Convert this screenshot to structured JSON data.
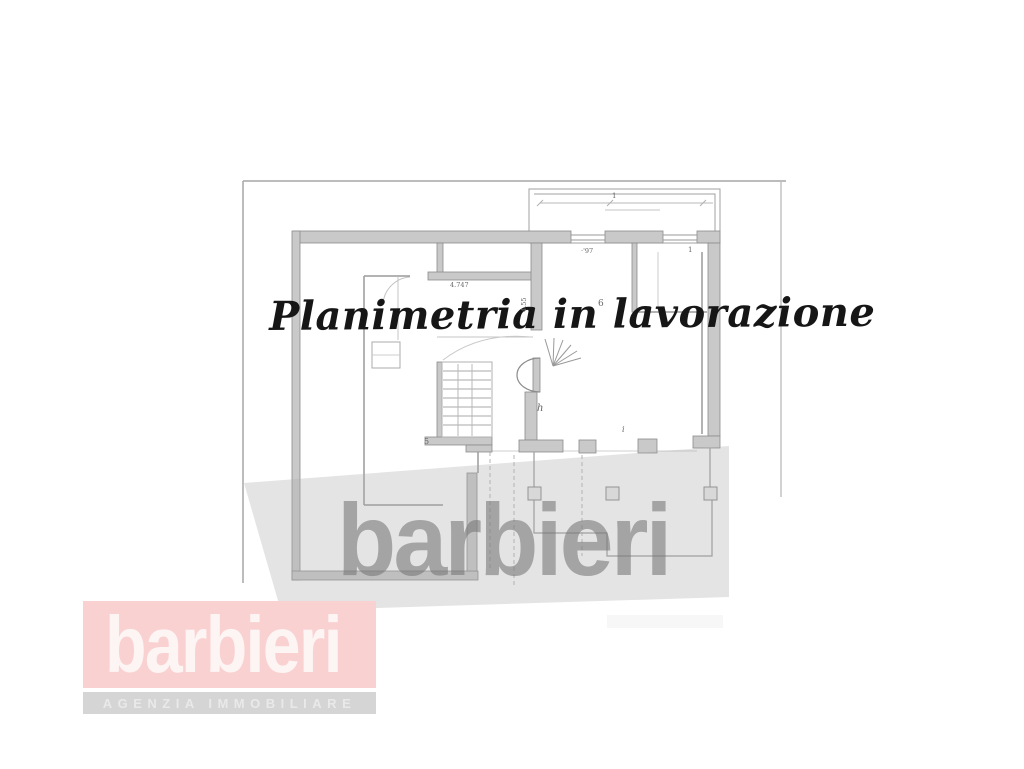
{
  "watermarks": {
    "script_text": "Planimetria in lavorazione",
    "brand_text": "barbieri",
    "brand_color": "#b5b5b5",
    "band_color": "rgba(172,172,172,0.32)"
  },
  "logo": {
    "brand": "barbieri",
    "subtitle": "AGENZIA IMMOBILIARE",
    "brand_bg_color": "#fad1d1",
    "brand_text_color": "#fdf4f4",
    "subtitle_bg_color": "#d5d5d5",
    "subtitle_text_color": "#e9e9e9"
  },
  "plan": {
    "labels": [
      {
        "name": "room-number-6",
        "text": "6"
      },
      {
        "name": "stair-letter-h",
        "text": "h"
      },
      {
        "name": "wall-number-5",
        "text": "5"
      },
      {
        "name": "dimension-4747",
        "text": "4.747"
      },
      {
        "name": "dimension-455",
        "text": "4.55"
      },
      {
        "name": "dimension-97",
        "text": "·'97"
      },
      {
        "name": "dimension-1-top",
        "text": "1"
      },
      {
        "name": "dimension-1-right",
        "text": "1"
      },
      {
        "name": "dimension-i",
        "text": "i"
      }
    ],
    "colors": {
      "wall_fill": "#c9c9c9",
      "wall_stroke": "#8c8c8c",
      "thin_line": "#9a9a9a",
      "border_line": "#a6a6a6"
    }
  }
}
